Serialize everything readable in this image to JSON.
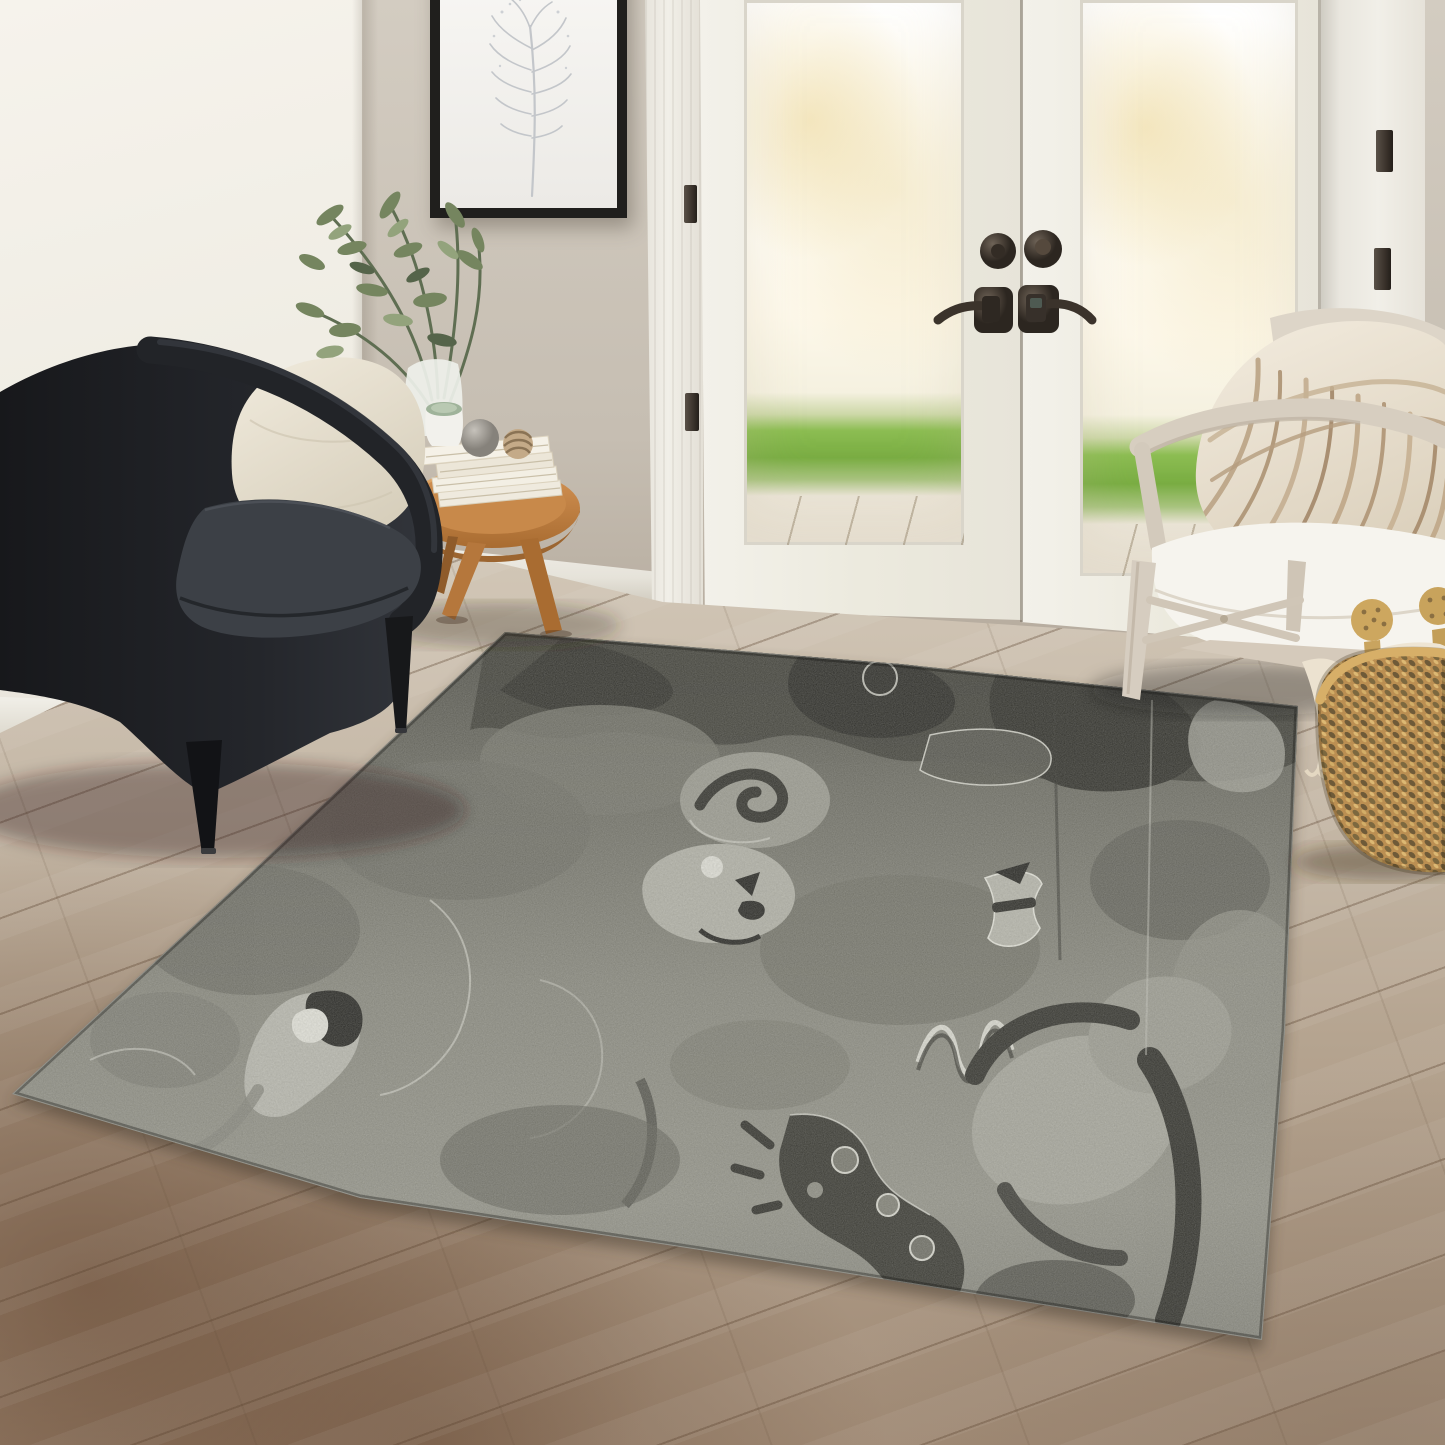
{
  "meta": {
    "type": "photograph",
    "description": "Sunlit living room product scene featuring a charcoal gray abstract-collage area rug on angled wood flooring, flanked by a black barrel armchair with a cream pillow, a round oak side table stacked with white books and decor spheres, a leafy green plant, a thin black framed botanical line print, white French patio doors with bronze hardware opening to green grass, a whitewashed wood accent chair with a white cushion and striped cream pillow, and a woven seagrass basket holding a tasseled cream throw."
  },
  "scene": {
    "objects": {
      "rug": "charcoal abstract area rug",
      "armchair": "black barrel armchair",
      "armchair_pillow": "cream throw pillow",
      "side_table": "round oak tripod side table",
      "books": "stack of four white books",
      "decor_spheres": "gray stone sphere and rope sphere",
      "mug": "white mug with sage interior",
      "plant": "green leafy plant in glass vase",
      "artwork": "framed botanical line-art print",
      "french_doors": "white double French doors",
      "door_hardware": "oil-rubbed bronze deadbolts and levers",
      "outdoor_view": "bright lawn and concrete patio",
      "accent_chair": "whitewashed wood accent chair",
      "accent_pillow": "cream pillow with tan squiggle stripes",
      "basket": "woven seagrass basket",
      "throw": "cream knit throw with tassels",
      "floor": "wide-plank hardwood floor",
      "walls": "cream wall and greige accent wall"
    }
  },
  "colors": {
    "wall_left_top": "#f6f3ec",
    "wall_left_mid": "#efece3",
    "wall_left_bottom": "#e5e1d7",
    "wall_accent_top": "#d3ccc1",
    "wall_accent_mid": "#c6beb2",
    "wall_accent_bottom": "#ab9f91",
    "trim": "#f1efe8",
    "door_white": "#f3f1ea",
    "frame_black": "#201f1d",
    "grass": "#8cbd52",
    "patio": "#f0eadf",
    "threshold": "#2e2822",
    "hardware": "#453c33",
    "floor_top": "#d2c7b7",
    "floor_mid": "#b5a490",
    "floor_low": "#a08a75",
    "rug_base": "#80807750",
    "rug_dark": "#31312c",
    "rug_deep": "#21211e",
    "rug_mid": "#62625a",
    "rug_light": "#a6a69c",
    "rug_cream": "#d8d8cf",
    "chair_black": "#202226",
    "chair_cushion": "#3c4046",
    "pillow_cream": "#ece5d6",
    "oak": "#c2823f",
    "book_white": "#f2eee3",
    "wood_chair": "#d8cfc2",
    "seat_white": "#f6f4ee",
    "stripe_tan": "#b99f82",
    "basket_tan": "#bd9254",
    "basket_dark": "#705c3a",
    "throw_cream": "#eee5d4",
    "plant_green": "#72815d"
  }
}
